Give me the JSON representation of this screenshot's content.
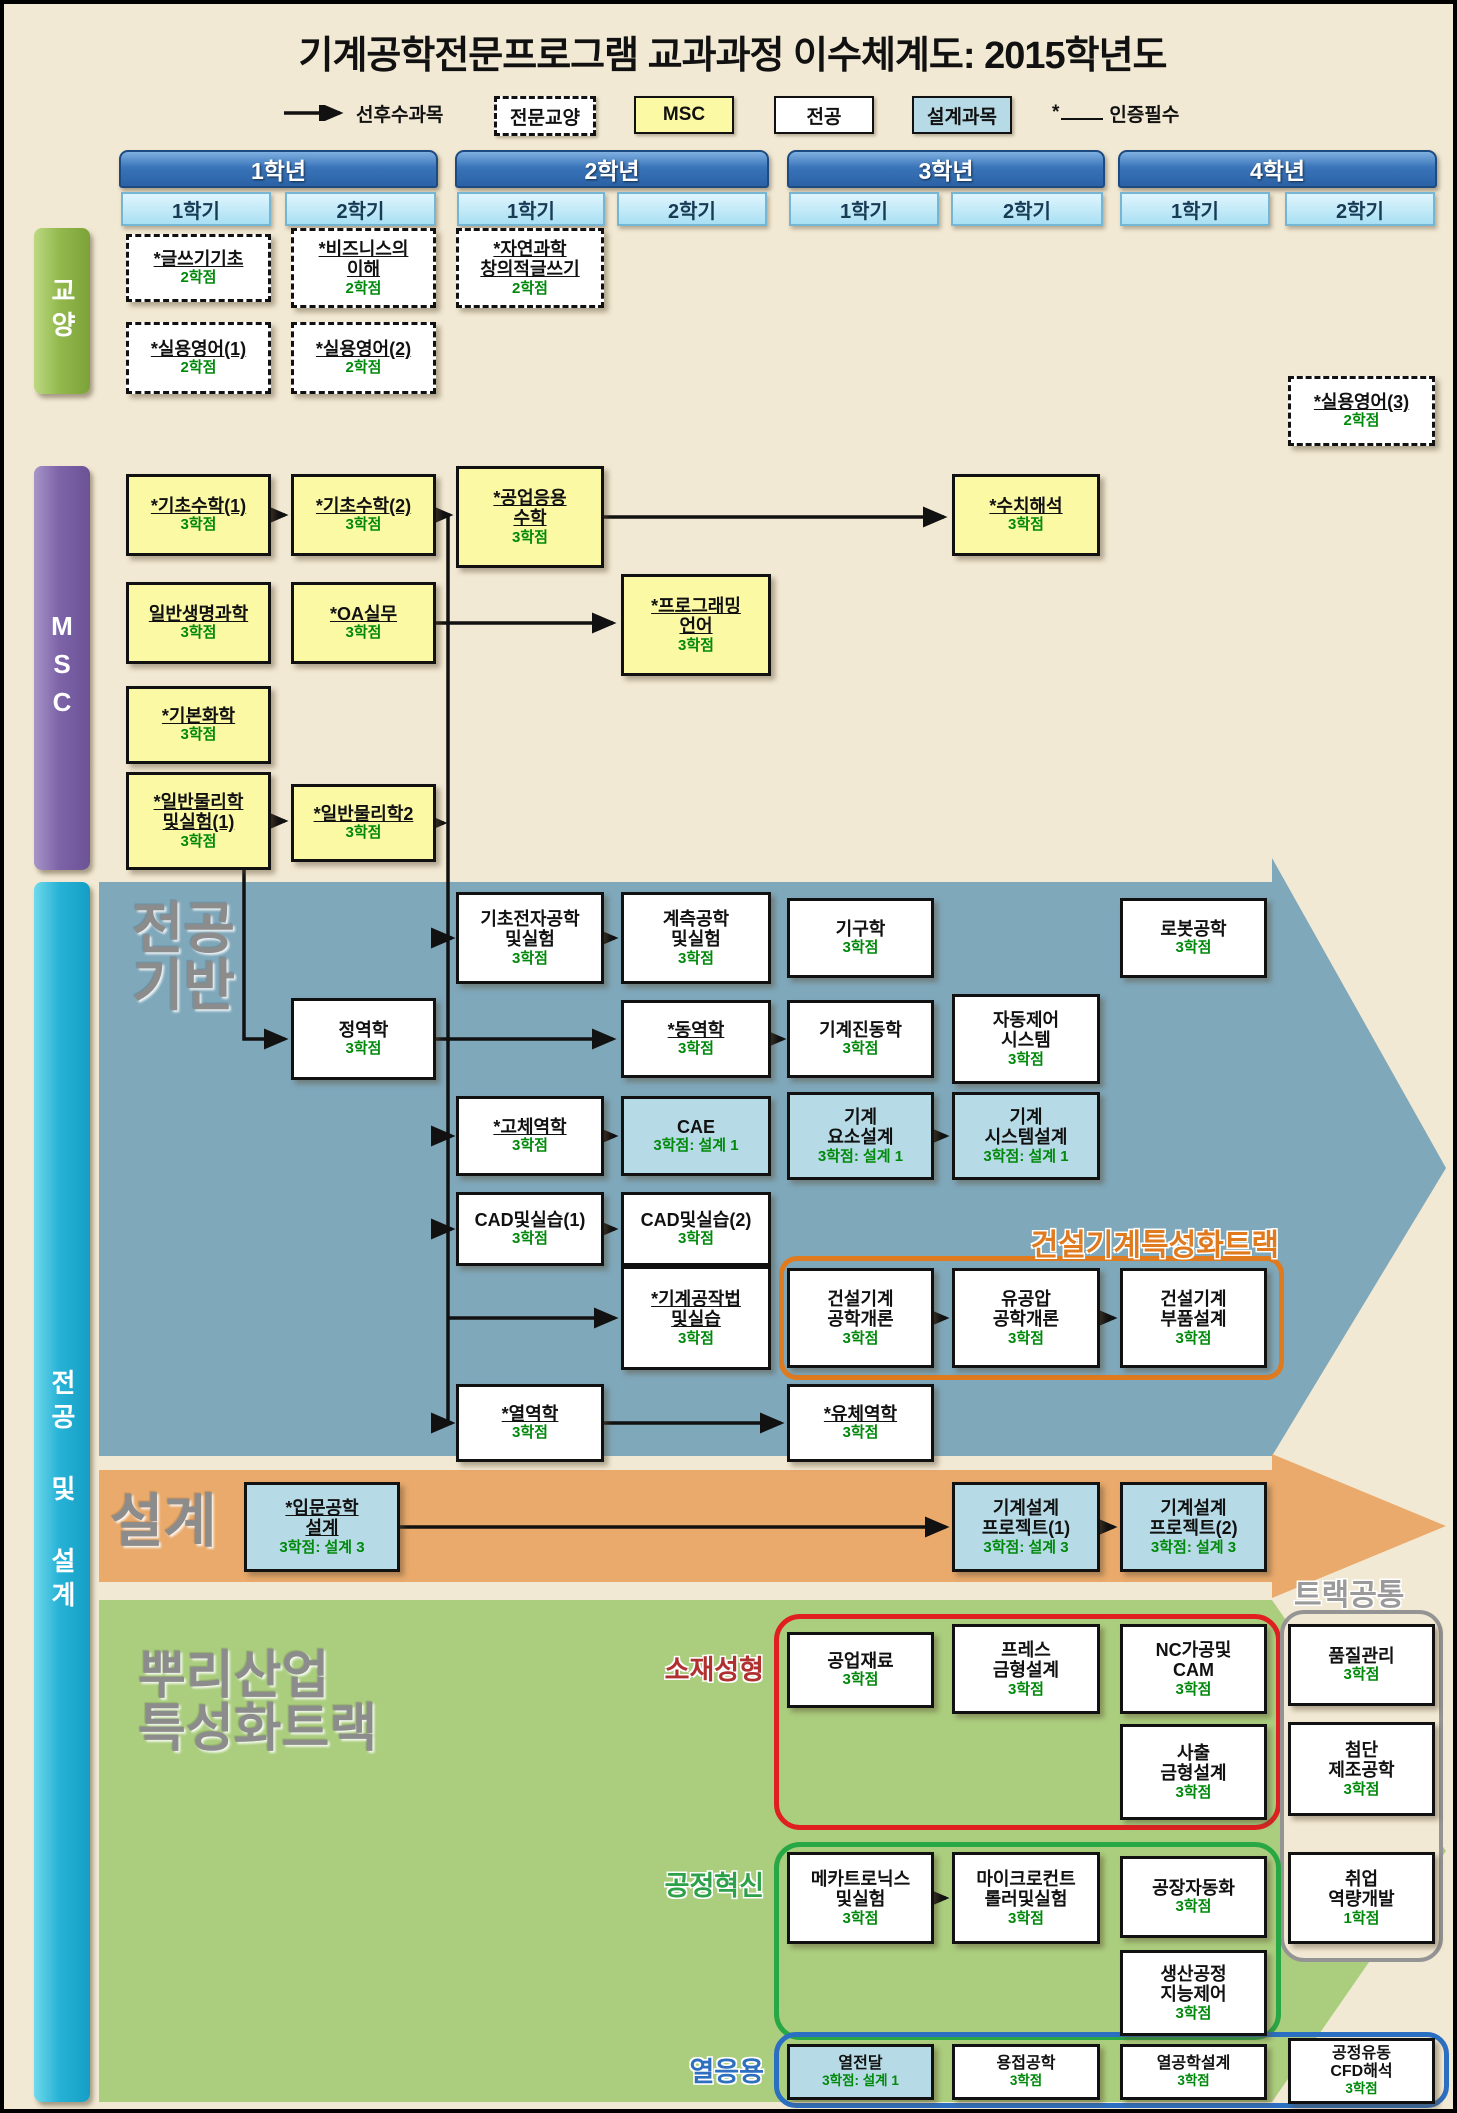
{
  "title": "기계공학전문프로그램 교과과정 이수체계도: 2015학년도",
  "legend": {
    "prereq": "선후수과목",
    "liberal": "전문교양",
    "msc": "MSC",
    "major": "전공",
    "design": "설계과목",
    "star": "*",
    "cert": "인증필수"
  },
  "years": [
    "1학년",
    "2학년",
    "3학년",
    "4학년"
  ],
  "semester_labels": [
    "1학기",
    "2학기"
  ],
  "sidebar": {
    "ge": "교양",
    "msc": "MSC",
    "major_design": "전공 및 설계"
  },
  "bands": {
    "major_base": "전공\n기반",
    "design": "설계",
    "root": "뿌리산업\n특성화트랙"
  },
  "track_labels": {
    "construction": "건설기계특성화트랙",
    "common": "트랙공통",
    "material": "소재성형",
    "process": "공정혁신",
    "thermal": "열응용"
  },
  "colors": {
    "background": "#f2e9d4",
    "band_blue": "#7fa8bb",
    "band_orange": "#e9aa6c",
    "band_green": "#abce7e",
    "msc_box": "#fbf9a4",
    "design_box": "#b7dbe6",
    "credit_green": "#00890b",
    "construction_track": "#e07a1f",
    "material_track": "#b03030",
    "process_track": "#2da04a",
    "thermal_track": "#2f6fc0",
    "common_track": "#9a9a9a"
  },
  "courses": {
    "writing": {
      "name": "*글쓰기기초",
      "credit": "2학점"
    },
    "business": {
      "name": "*비즈니스의\n이해",
      "credit": "2학점"
    },
    "sciwriting": {
      "name": "*자연과학\n창의적글쓰기",
      "credit": "2학점"
    },
    "eng1": {
      "name": "*실용영어(1)",
      "credit": "2학점"
    },
    "eng2": {
      "name": "*실용영어(2)",
      "credit": "2학점"
    },
    "eng3": {
      "name": "*실용영어(3)",
      "credit": "2학점"
    },
    "math1": {
      "name": "*기초수학(1)",
      "credit": "3학점"
    },
    "math2": {
      "name": "*기초수학(2)",
      "credit": "3학점"
    },
    "engmath": {
      "name": "*공업응용\n수학",
      "credit": "3학점"
    },
    "numeric": {
      "name": "*수치해석",
      "credit": "3학점"
    },
    "bio": {
      "name": "일반생명과학",
      "credit": "3학점"
    },
    "oa": {
      "name": "*OA실무",
      "credit": "3학점"
    },
    "prog": {
      "name": "*프로그래밍\n언어",
      "credit": "3학점"
    },
    "chem": {
      "name": "*기본화학",
      "credit": "3학점"
    },
    "phys1": {
      "name": "*일반물리학\n및실험(1)",
      "credit": "3학점"
    },
    "phys2": {
      "name": "*일반물리학2",
      "credit": "3학점"
    },
    "elec": {
      "name": "기초전자공학\n및실험",
      "credit": "3학점"
    },
    "inst": {
      "name": "계측공학\n및실험",
      "credit": "3학점"
    },
    "kinematics": {
      "name": "기구학",
      "credit": "3학점"
    },
    "robot": {
      "name": "로봇공학",
      "credit": "3학점"
    },
    "statics": {
      "name": "정역학",
      "credit": "3학점"
    },
    "dynamics": {
      "name": "*동역학",
      "credit": "3학점"
    },
    "vibration": {
      "name": "기계진동학",
      "credit": "3학점"
    },
    "autocontrol": {
      "name": "자동제어\n시스템",
      "credit": "3학점"
    },
    "solid": {
      "name": "*고체역학",
      "credit": "3학점"
    },
    "cae": {
      "name": "CAE",
      "credit": "3학점: 설계 1"
    },
    "elements": {
      "name": "기계\n요소설계",
      "credit": "3학점: 설계 1"
    },
    "sysdesign": {
      "name": "기계\n시스템설계",
      "credit": "3학점: 설계 1"
    },
    "cad1": {
      "name": "CAD및실습(1)",
      "credit": "3학점"
    },
    "cad2": {
      "name": "CAD및실습(2)",
      "credit": "3학점"
    },
    "machining": {
      "name": "*기계공작법\n및실습",
      "credit": "3학점"
    },
    "constr_intro": {
      "name": "건설기계\n공학개론",
      "credit": "3학점"
    },
    "hydraulics": {
      "name": "유공압\n공학개론",
      "credit": "3학점"
    },
    "constr_parts": {
      "name": "건설기계\n부품설계",
      "credit": "3학점"
    },
    "thermo": {
      "name": "*열역학",
      "credit": "3학점"
    },
    "fluid": {
      "name": "*유체역학",
      "credit": "3학점"
    },
    "introdesign": {
      "name": "*입문공학\n설계",
      "credit": "3학점: 설계 3"
    },
    "proj1": {
      "name": "기계설계\n프로젝트(1)",
      "credit": "3학점: 설계 3"
    },
    "proj2": {
      "name": "기계설계\n프로젝트(2)",
      "credit": "3학점: 설계 3"
    },
    "materials": {
      "name": "공업재료",
      "credit": "3학점"
    },
    "press": {
      "name": "프레스\n금형설계",
      "credit": "3학점"
    },
    "nc": {
      "name": "NC가공및\nCAM",
      "credit": "3학점"
    },
    "injection": {
      "name": "사출\n금형설계",
      "credit": "3학점"
    },
    "quality": {
      "name": "품질관리",
      "credit": "3학점"
    },
    "advmfg": {
      "name": "첨단\n제조공학",
      "credit": "3학점"
    },
    "career": {
      "name": "취업\n역량개발",
      "credit": "1학점"
    },
    "mecha": {
      "name": "메카트로닉스\n및실험",
      "credit": "3학점"
    },
    "micro": {
      "name": "마이크로컨트\n롤러및실험",
      "credit": "3학점"
    },
    "factory": {
      "name": "공장자동화",
      "credit": "3학점"
    },
    "prodintel": {
      "name": "생산공정\n지능제어",
      "credit": "3학점"
    },
    "heat": {
      "name": "열전달",
      "credit": "3학점: 설계 1"
    },
    "welding": {
      "name": "용접공학",
      "credit": "3학점"
    },
    "thermdesign": {
      "name": "열공학설계",
      "credit": "3학점"
    },
    "cfd": {
      "name": "공정유동\nCFD해석",
      "credit": "3학점"
    }
  }
}
